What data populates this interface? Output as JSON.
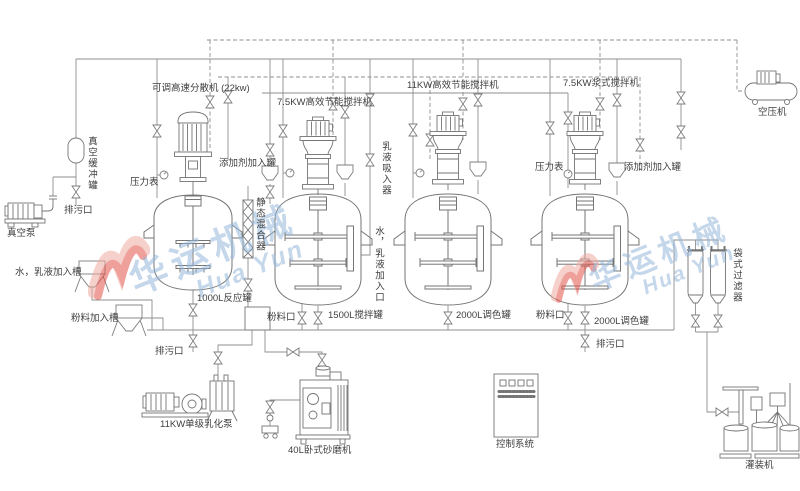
{
  "watermark": {
    "cn": "华运机械",
    "en": "Hua Yun"
  },
  "colors": {
    "pipe_line": "#8a8a8a",
    "equipment_line": "#757575",
    "label_text": "#3f3f3f",
    "watermark_blue": "#96b6d8",
    "watermark_red": "#e2544b"
  },
  "labels": {
    "disperser": "可调高速分散机 (22kw)",
    "mixer_7_5kw": "7.5KW高效节能搅拌机",
    "mixer_11kw": "11KW高效节能搅拌机",
    "mixer_paddle": "7.5KW浆式搅拌机",
    "air_compressor": "空压机",
    "vacuum_buffer_tank": "真空缓冲罐",
    "vacuum_pump": "真空泵",
    "drain": "排污口",
    "pressure_gauge": "压力表",
    "additive_tank": "添加剂加入罐",
    "static_mixer": "静态混合器",
    "water_emulsion_hopper": "水，乳液加入槽",
    "powder_hopper": "粉料加入槽",
    "reactor_1000l": "1000L反应罐",
    "powder_port": "粉料口",
    "mixing_tank_1500l": "1500L搅拌罐",
    "emulsion_suction": "乳液吸入器",
    "water_emulsion_inlet": "水，乳液加入口",
    "tinting_tank_2000l": "2000L调色罐",
    "bag_filter": "袋式过滤器",
    "emulsify_pump": "11KW单级乳化泵",
    "sand_mill": "40L卧式砂磨机",
    "control_system": "控制系统",
    "filling_machine": "灌装机"
  }
}
